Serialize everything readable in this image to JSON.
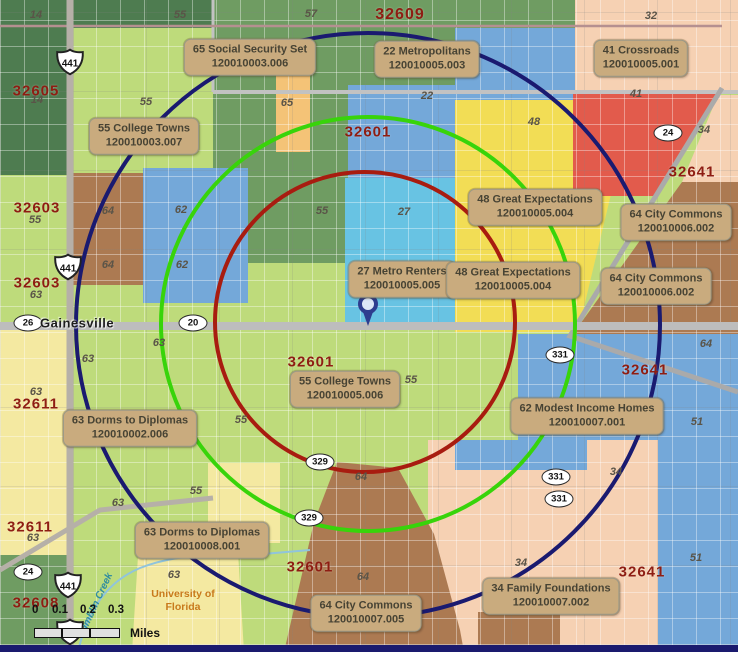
{
  "map": {
    "city_label": "Gainesville",
    "creek_label": "Tumblin Creek",
    "university": {
      "line1": "University of",
      "line2": "Florida"
    },
    "scale_bar": {
      "ticks": [
        "0",
        "0.1",
        "0.2",
        "0.3"
      ],
      "unit_label": "Miles"
    },
    "palette": {
      "dark_green": "#4e7c50",
      "medium_green": "#6f9c62",
      "light_green": "#bedb7b",
      "pale_yellow": "#f4e9a1",
      "yellow": "#f2dd55",
      "blue": "#74a8d9",
      "cyan": "#68c3e3",
      "orange": "#f4c377",
      "red": "#e25b4c",
      "brown": "#ac7a52",
      "peach": "#f6d1b3",
      "callout_bg": "#c9ab7e",
      "zip_text": "#8e1d12",
      "frame_navy": "#1a1a6e"
    },
    "rings": [
      {
        "name": "outer-ring",
        "color": "#1a1a70",
        "cx": 368,
        "cy": 325,
        "r": 292
      },
      {
        "name": "middle-ring",
        "color": "#38d40a",
        "cx": 368,
        "cy": 324,
        "r": 207
      },
      {
        "name": "inner-ring",
        "color": "#a81c10",
        "cx": 365,
        "cy": 322,
        "r": 150
      }
    ],
    "pin": {
      "x": 368,
      "y": 326,
      "color": "#2e3d8f"
    },
    "callouts": [
      {
        "segment": "65 Social Security Set",
        "code": "120010003.006",
        "x": 250,
        "y": 57
      },
      {
        "segment": "22 Metropolitans",
        "code": "120010005.003",
        "x": 427,
        "y": 59
      },
      {
        "segment": "41 Crossroads",
        "code": "120010005.001",
        "x": 641,
        "y": 58
      },
      {
        "segment": "55 College Towns",
        "code": "120010003.007",
        "x": 144,
        "y": 136
      },
      {
        "segment": "48 Great Expectations",
        "code": "120010005.004",
        "x": 535,
        "y": 207
      },
      {
        "segment": "64 City Commons",
        "code": "120010006.002",
        "x": 676,
        "y": 222
      },
      {
        "segment": "27 Metro Renters",
        "code": "120010005.005",
        "x": 402,
        "y": 279
      },
      {
        "segment": "48 Great Expectations",
        "code": "120010005.004",
        "x": 513,
        "y": 280
      },
      {
        "segment": "64 City Commons",
        "code": "120010006.002",
        "x": 656,
        "y": 286
      },
      {
        "segment": "55 College Towns",
        "code": "120010005.006",
        "x": 345,
        "y": 389
      },
      {
        "segment": "62 Modest Income Homes",
        "code": "120010007.001",
        "x": 587,
        "y": 416
      },
      {
        "segment": "63 Dorms to Diplomas",
        "code": "120010002.006",
        "x": 130,
        "y": 428
      },
      {
        "segment": "63 Dorms to Diplomas",
        "code": "120010008.001",
        "x": 202,
        "y": 540
      },
      {
        "segment": "34 Family Foundations",
        "code": "120010007.002",
        "x": 551,
        "y": 596
      },
      {
        "segment": "64 City Commons",
        "code": "120010007.005",
        "x": 366,
        "y": 613
      }
    ],
    "zip_labels": [
      {
        "text": "32609",
        "x": 400,
        "y": 15,
        "size": 16
      },
      {
        "text": "32605",
        "x": 36,
        "y": 91,
        "size": 15
      },
      {
        "text": "32601",
        "x": 368,
        "y": 132,
        "size": 15
      },
      {
        "text": "32603",
        "x": 37,
        "y": 208,
        "size": 15
      },
      {
        "text": "32603",
        "x": 37,
        "y": 283,
        "size": 15
      },
      {
        "text": "32641",
        "x": 692,
        "y": 172,
        "size": 15
      },
      {
        "text": "32601",
        "x": 311,
        "y": 362,
        "size": 15
      },
      {
        "text": "32641",
        "x": 645,
        "y": 370,
        "size": 15
      },
      {
        "text": "32611",
        "x": 36,
        "y": 404,
        "size": 15
      },
      {
        "text": "32611",
        "x": 30,
        "y": 527,
        "size": 15
      },
      {
        "text": "32601",
        "x": 310,
        "y": 567,
        "size": 15
      },
      {
        "text": "32641",
        "x": 642,
        "y": 572,
        "size": 15
      },
      {
        "text": "32608",
        "x": 36,
        "y": 603,
        "size": 15
      }
    ],
    "area_numbers": [
      {
        "text": "14",
        "x": 36,
        "y": 15
      },
      {
        "text": "55",
        "x": 180,
        "y": 15
      },
      {
        "text": "57",
        "x": 311,
        "y": 14
      },
      {
        "text": "32",
        "x": 651,
        "y": 16
      },
      {
        "text": "14",
        "x": 37,
        "y": 100
      },
      {
        "text": "55",
        "x": 146,
        "y": 102
      },
      {
        "text": "65",
        "x": 287,
        "y": 103
      },
      {
        "text": "22",
        "x": 427,
        "y": 96
      },
      {
        "text": "41",
        "x": 636,
        "y": 94
      },
      {
        "text": "48",
        "x": 534,
        "y": 122
      },
      {
        "text": "34",
        "x": 704,
        "y": 130
      },
      {
        "text": "64",
        "x": 108,
        "y": 211
      },
      {
        "text": "62",
        "x": 181,
        "y": 210
      },
      {
        "text": "55",
        "x": 35,
        "y": 220
      },
      {
        "text": "27",
        "x": 404,
        "y": 212
      },
      {
        "text": "55",
        "x": 322,
        "y": 211
      },
      {
        "text": "64",
        "x": 108,
        "y": 265
      },
      {
        "text": "62",
        "x": 182,
        "y": 265
      },
      {
        "text": "63",
        "x": 36,
        "y": 295
      },
      {
        "text": "63",
        "x": 159,
        "y": 343
      },
      {
        "text": "63",
        "x": 88,
        "y": 359
      },
      {
        "text": "63",
        "x": 36,
        "y": 392
      },
      {
        "text": "55",
        "x": 241,
        "y": 420
      },
      {
        "text": "55",
        "x": 411,
        "y": 380
      },
      {
        "text": "64",
        "x": 706,
        "y": 344
      },
      {
        "text": "51",
        "x": 697,
        "y": 422
      },
      {
        "text": "55",
        "x": 196,
        "y": 491
      },
      {
        "text": "63",
        "x": 118,
        "y": 503
      },
      {
        "text": "63",
        "x": 33,
        "y": 538
      },
      {
        "text": "64",
        "x": 361,
        "y": 477
      },
      {
        "text": "34",
        "x": 616,
        "y": 472
      },
      {
        "text": "64",
        "x": 363,
        "y": 577
      },
      {
        "text": "34",
        "x": 521,
        "y": 563
      },
      {
        "text": "51",
        "x": 696,
        "y": 558
      },
      {
        "text": "63",
        "x": 174,
        "y": 575
      }
    ],
    "us_route_shields": [
      {
        "text": "441",
        "x": 70,
        "y": 62
      },
      {
        "text": "441",
        "x": 68,
        "y": 267
      },
      {
        "text": "441",
        "x": 68,
        "y": 585
      },
      {
        "text": "441",
        "x": 70,
        "y": 632
      }
    ],
    "state_route_shields": [
      {
        "text": "24",
        "x": 668,
        "y": 133
      },
      {
        "text": "26",
        "x": 28,
        "y": 323
      },
      {
        "text": "20",
        "x": 193,
        "y": 323
      },
      {
        "text": "331",
        "x": 560,
        "y": 355
      },
      {
        "text": "329",
        "x": 320,
        "y": 462
      },
      {
        "text": "331",
        "x": 556,
        "y": 477
      },
      {
        "text": "331",
        "x": 559,
        "y": 499
      },
      {
        "text": "329",
        "x": 309,
        "y": 518
      },
      {
        "text": "24",
        "x": 28,
        "y": 572
      }
    ]
  }
}
